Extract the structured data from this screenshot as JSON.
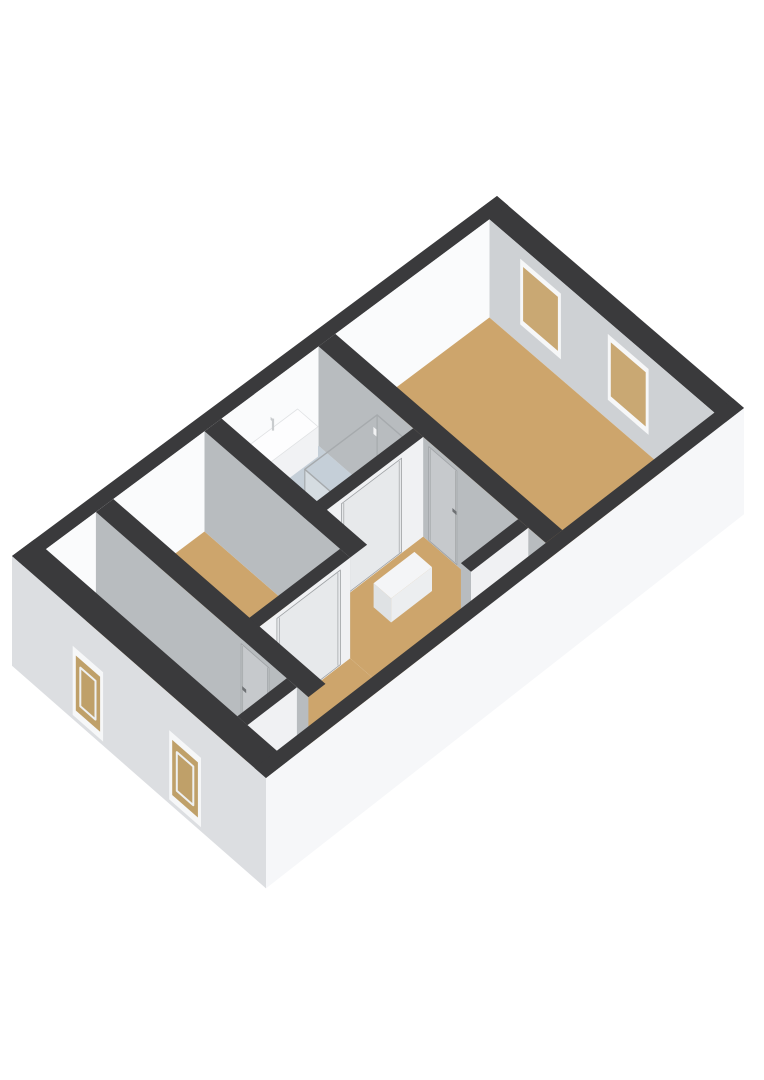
{
  "meta": {
    "description": "3d-isometric-floorplan-render",
    "background_color": "#ffffff"
  },
  "projection": {
    "corner_n": [
      497,
      196
    ],
    "corner_e": [
      744,
      408
    ],
    "corner_w": [
      12,
      556
    ],
    "corner_s": [
      266,
      778
    ],
    "wall_height": 100,
    "exterior_drop": 108
  },
  "colors": {
    "cap": "#3a3a3c",
    "neFace": "#ced1d4",
    "nwFace": "#fafbfc",
    "seInt": "#f2f3f5",
    "swInt": "#e7e9eb",
    "faceGray": "#b8bcbf",
    "faceLit": "#f0f1f3",
    "tan": "#cda56c",
    "bath": "#c5cfd8",
    "storage": "#e9ebed",
    "swExt": "#dcdee1",
    "seExt": "#f6f7f9",
    "frame": "#f6f7f8",
    "glassIn": "#c9a873",
    "glassInSW": "#d2b582",
    "glassOut": "#bfa069",
    "sash": "#eef0f1",
    "doorA": "#c6c9cc",
    "doorB": "#e7e9eb",
    "doorLine": "#9fa2a5",
    "handle": "#6e7174",
    "sinkTop": "#fdfdfe",
    "sinkTopEdge": "#e0e2e4",
    "sinkSW": "#e8eaec",
    "sinkSE": "#f1f2f4",
    "faucet": "#c9ccce",
    "glassEdge": "#a6aaad",
    "glassFillSE": "rgba(240,244,246,0.45)",
    "glassFillSW": "rgba(226,231,234,0.55)",
    "tray": "#dde5ea",
    "showerHead": "#f2f3f4",
    "boxTop": "#f4f5f7",
    "boxSW": "#dfe2e4",
    "boxSE": "#eceef0"
  },
  "paint": [
    {
      "t": "cap",
      "name": "ne-wall-cap",
      "r": [
        0,
        0,
        1,
        0.04
      ]
    },
    {
      "t": "cap",
      "name": "nw-wall-cap",
      "r": [
        0,
        0,
        0.045,
        1
      ]
    },
    {
      "t": "faceA",
      "name": "ne-wall-interior",
      "v": 0.04,
      "u": [
        0.045,
        0.955
      ],
      "c": "neFace"
    },
    {
      "t": "winIn",
      "name": "bedroom-large-window-1",
      "u": [
        0.17,
        0.335
      ]
    },
    {
      "t": "winIn",
      "name": "bedroom-large-window-2",
      "u": [
        0.525,
        0.69
      ]
    },
    {
      "t": "faceB",
      "name": "nw-wall-interior",
      "u": 0.045,
      "v": [
        0.04,
        0.955
      ],
      "c": "nwFace"
    },
    {
      "t": "faceB",
      "name": "se-wall-interior",
      "u": 0.955,
      "v": [
        0.04,
        0.955
      ],
      "c": "seInt"
    },
    {
      "t": "faceA",
      "name": "sw-wall-interior",
      "v": 0.955,
      "u": [
        0.045,
        0.955
      ],
      "c": "swInt"
    },
    {
      "t": "winInSW",
      "name": "room-bottom-window-1-inside",
      "u": [
        0.24,
        0.36
      ]
    },
    {
      "t": "winInSW",
      "name": "room-bottom-window-2-inside",
      "u": [
        0.62,
        0.745
      ]
    },
    {
      "t": "floor",
      "name": "bedroom-large-floor",
      "r": [
        0.045,
        0.04,
        0.955,
        0.365
      ],
      "c": "tan"
    },
    {
      "t": "floor",
      "name": "bathroom-floor",
      "r": [
        0.045,
        0.4,
        0.425,
        0.6
      ],
      "c": "bath"
    },
    {
      "t": "floor",
      "name": "landing-floor-upper",
      "r": [
        0.465,
        0.4,
        0.955,
        0.635
      ],
      "c": "tan"
    },
    {
      "t": "floor",
      "name": "landing-floor-lower",
      "r": [
        0.625,
        0.635,
        0.955,
        0.855
      ],
      "c": "tan"
    },
    {
      "t": "floor",
      "name": "bedroom-left-floor",
      "r": [
        0.045,
        0.635,
        0.585,
        0.82
      ],
      "c": "tan"
    },
    {
      "t": "floor",
      "name": "room-bottom-floor",
      "r": [
        0.045,
        0.855,
        0.8,
        0.955
      ],
      "c": "tan"
    },
    {
      "t": "floor",
      "name": "storage-nook-floor",
      "r": [
        0.84,
        0.855,
        0.955,
        0.955
      ],
      "c": "storage"
    },
    {
      "t": "wallA",
      "name": "wall-bedroom-large",
      "u": [
        0.045,
        0.955
      ],
      "v": [
        0.365,
        0.4
      ]
    },
    {
      "t": "door",
      "name": "bedroom-large-door",
      "on": "A",
      "v": 0.4,
      "u": [
        0.487,
        0.6
      ],
      "handle": 0.586,
      "hdz": 46
    },
    {
      "t": "sink",
      "name": "bathroom-sink",
      "u": [
        0.048,
        0.13
      ],
      "v": [
        0.445,
        0.565
      ],
      "top": 46,
      "bottom": 76
    },
    {
      "t": "shower",
      "name": "shower-enclosure",
      "r": [
        0.29,
        0.405,
        0.425,
        0.555
      ]
    },
    {
      "t": "wallB",
      "name": "wall-bathroom-landing",
      "u": [
        0.425,
        0.465
      ],
      "v": [
        0.4,
        0.635
      ]
    },
    {
      "t": "door",
      "name": "bathroom-door",
      "on": "B",
      "u": 0.465,
      "v": [
        0.445,
        0.57
      ],
      "handle": 0.556,
      "hdz": 50
    },
    {
      "t": "wallA",
      "name": "wall-bathroom-bedroom-left",
      "u": [
        0.045,
        0.625
      ],
      "v": [
        0.6,
        0.635
      ]
    },
    {
      "t": "wallB",
      "name": "wall-bedroom-left-landing",
      "u": [
        0.585,
        0.625
      ],
      "v": [
        0.635,
        0.855
      ]
    },
    {
      "t": "door",
      "name": "bedroom-left-door",
      "on": "B",
      "u": 0.625,
      "v": [
        0.655,
        0.785
      ],
      "handle": 0.772,
      "hdz": 46
    },
    {
      "t": "wallB",
      "name": "closet-wall",
      "u": [
        0.845,
        0.885
      ],
      "v": [
        0.4,
        0.52
      ],
      "endSW": true
    },
    {
      "t": "box",
      "name": "landing-floor-box",
      "r": [
        0.545,
        0.46,
        0.615,
        0.545
      ],
      "top": 76
    },
    {
      "t": "wallA",
      "name": "wall-landing-room-bottom",
      "u": [
        0.045,
        0.885
      ],
      "v": [
        0.82,
        0.855
      ]
    },
    {
      "t": "door",
      "name": "room-bottom-door",
      "on": "A",
      "v": 0.855,
      "u": [
        0.62,
        0.73
      ],
      "handle": 0.628,
      "hdz": 46
    },
    {
      "t": "wallB",
      "name": "wall-room-bottom-storage",
      "u": [
        0.8,
        0.84
      ],
      "v": [
        0.855,
        0.955
      ]
    },
    {
      "t": "extSW",
      "name": "sw-exterior-wall"
    },
    {
      "t": "winOut",
      "name": "sw-window-1",
      "u": [
        0.24,
        0.36
      ]
    },
    {
      "t": "winOut",
      "name": "sw-window-2",
      "u": [
        0.62,
        0.745
      ]
    },
    {
      "t": "cap",
      "name": "sw-wall-cap",
      "r": [
        0,
        0.955,
        1,
        1
      ]
    },
    {
      "t": "extSE",
      "name": "se-exterior-wall"
    },
    {
      "t": "cap",
      "name": "se-wall-cap",
      "r": [
        0.955,
        0,
        1,
        1
      ]
    }
  ]
}
